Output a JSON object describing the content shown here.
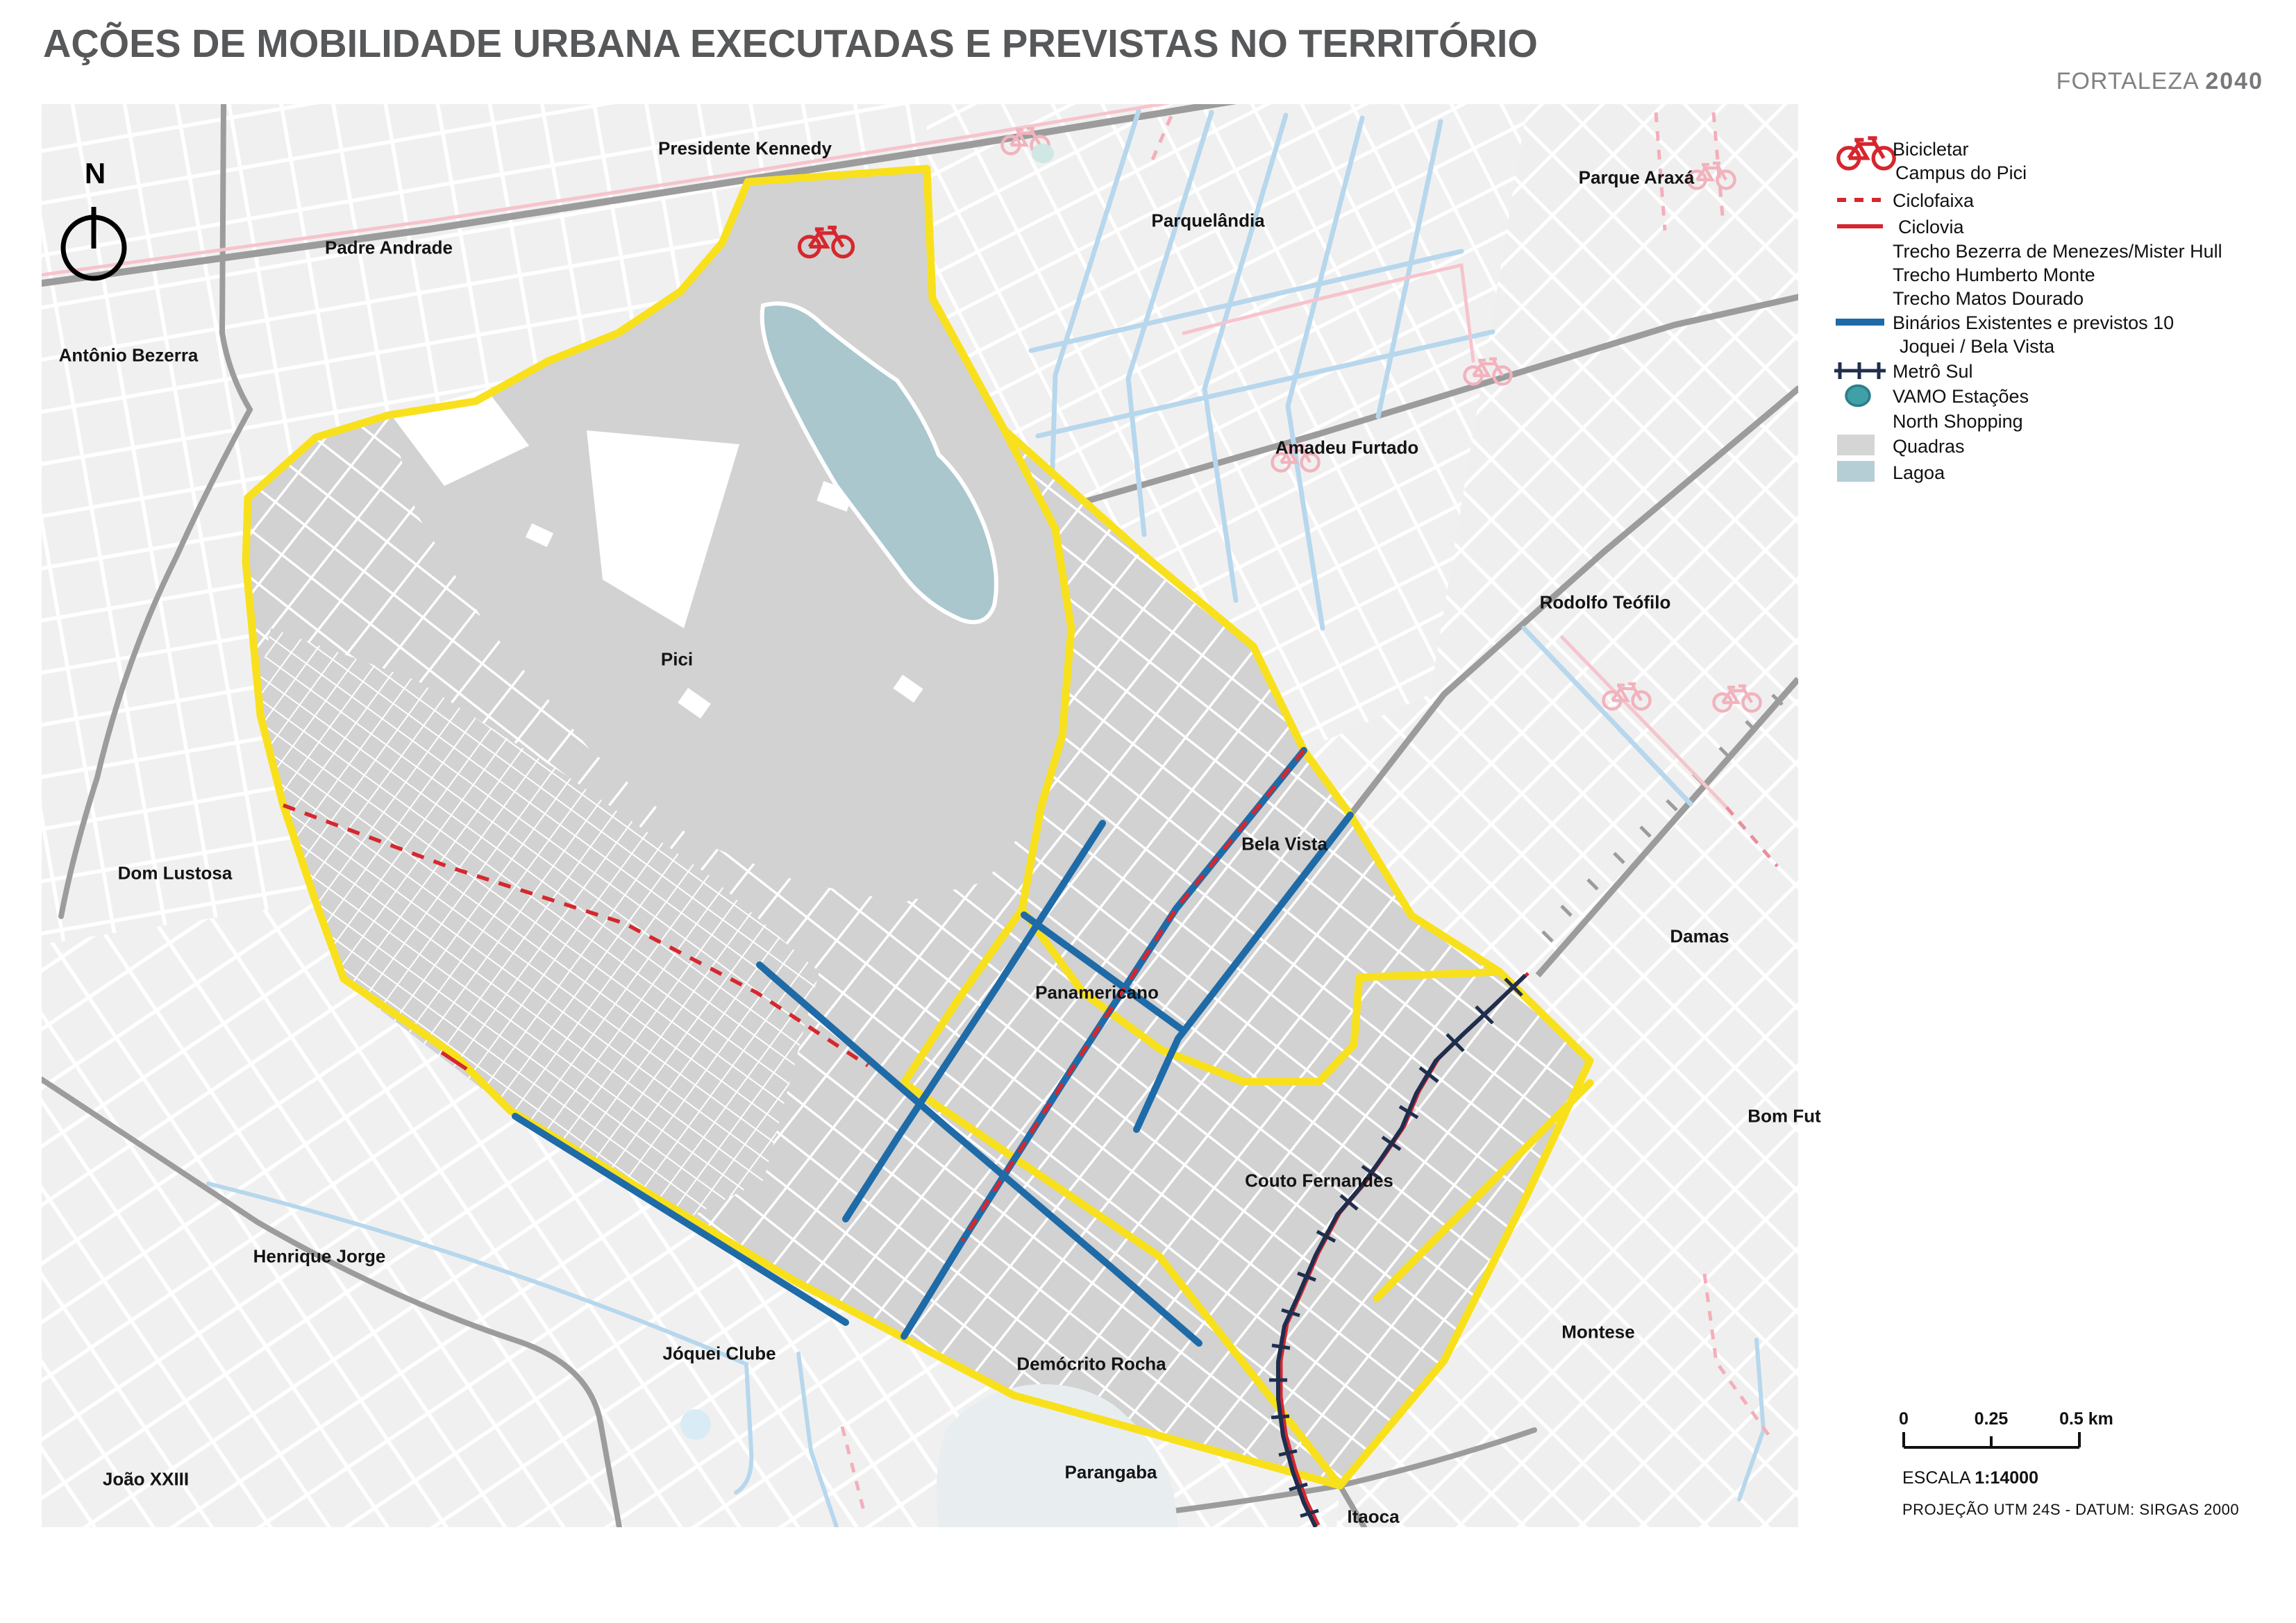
{
  "title": "AÇÕES DE MOBILIDADE URBANA EXECUTADAS E PREVISTAS NO TERRITÓRIO",
  "brand": {
    "city": "FORTALEZA",
    "year": "2040"
  },
  "north": {
    "label": "N"
  },
  "legend": {
    "items": [
      {
        "id": "bicicletar",
        "label": "Bicicletar",
        "swatch": "bicycle-icon"
      },
      {
        "id": "bicicletar2",
        "label": "Campus do Pici",
        "swatch": "none"
      },
      {
        "id": "ciclofaixa",
        "label": "Ciclofaixa",
        "swatch": "red-dashed-line"
      },
      {
        "id": "ciclovia",
        "label": "Ciclovia",
        "swatch": "red-solid-line"
      },
      {
        "id": "trecho1",
        "label": "Trecho Bezerra de Menezes/Mister Hull",
        "swatch": "none"
      },
      {
        "id": "trecho2",
        "label": "Trecho Humberto Monte",
        "swatch": "none"
      },
      {
        "id": "trecho3",
        "label": "Trecho Matos Dourado",
        "swatch": "none"
      },
      {
        "id": "binarios",
        "label": "Binários Existentes e previstos 10",
        "swatch": "blue-solid-line"
      },
      {
        "id": "binarios2",
        "label": "Joquei / Bela Vista",
        "swatch": "none"
      },
      {
        "id": "metro",
        "label": "Metrô Sul",
        "swatch": "navy-ticked-line"
      },
      {
        "id": "vamo",
        "label": "VAMO Estações",
        "swatch": "teal-circle"
      },
      {
        "id": "vamo2",
        "label": "North Shopping",
        "swatch": "none"
      },
      {
        "id": "quadras",
        "label": "Quadras",
        "swatch": "gray-square"
      },
      {
        "id": "lagoa",
        "label": "Lagoa",
        "swatch": "blue-square"
      }
    ]
  },
  "map": {
    "labels": [
      {
        "text": "Presidente Kennedy"
      },
      {
        "text": "Parque Araxá"
      },
      {
        "text": "Padre Andrade"
      },
      {
        "text": "Parquelândia"
      },
      {
        "text": "Antônio Bezerra"
      },
      {
        "text": "Amadeu Furtado"
      },
      {
        "text": "Rodolfo Teófilo"
      },
      {
        "text": "Pici"
      },
      {
        "text": "Dom Lustosa"
      },
      {
        "text": "Bela Vista"
      },
      {
        "text": "Damas"
      },
      {
        "text": "Panamericano"
      },
      {
        "text": "Bom Fut"
      },
      {
        "text": "Couto Fernandes"
      },
      {
        "text": "Henrique Jorge"
      },
      {
        "text": "Montese"
      },
      {
        "text": "Jóquei Clube"
      },
      {
        "text": "Demócrito Rocha"
      },
      {
        "text": "João XXIII"
      },
      {
        "text": "Parangaba"
      },
      {
        "text": "Itaoca"
      }
    ]
  },
  "scale": {
    "tick0": "0",
    "tick1": "0.25",
    "tick2": "0.5 km",
    "escala_label": "ESCALA",
    "escala_value": "1:14000",
    "projection": "PROJEÇÃO UTM 24S - DATUM: SIRGAS 2000"
  },
  "colors": {
    "territory_boundary_yellow": "#F8E11C",
    "binario_blue": "#1E6BA8",
    "ciclo_red": "#D6272E",
    "metro_navy": "#202E4E",
    "vamo_teal": "#3FA0A5",
    "lagoa_fill": "#A9C7CD",
    "quadras_inside": "#D2D2D2",
    "quadras_outside": "#F1F0F0",
    "existing_pink": "#F6C4CD",
    "existing_lightblue": "#B7D7ED",
    "road_gray": "#9C9C9C",
    "title_gray": "#57585A"
  }
}
